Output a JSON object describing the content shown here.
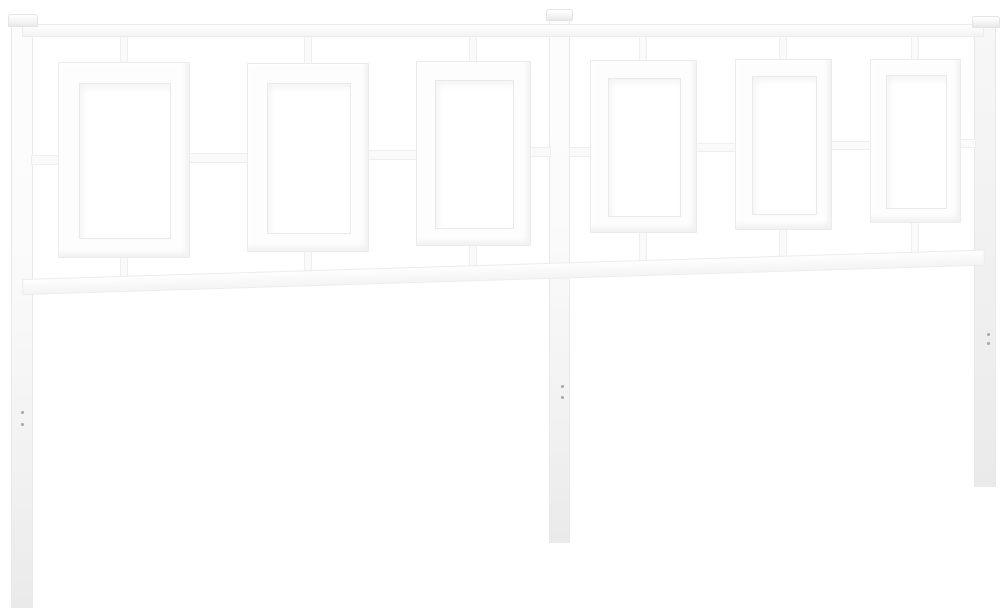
{
  "meta": {
    "description": "Product photo of a white metal bed headboard with three vertical posts, a top rail, a lower rail and six rectangular open frames linked by short square-tube connectors, photographed on a plain white background with slight perspective toward the right",
    "canvas": {
      "width": 1003,
      "height": 614
    },
    "colors": {
      "background": "#ffffff",
      "metal": "#fdfdfd",
      "metal_shade": "#efefef",
      "edge": "#e9e9e9",
      "hole_edge": "#e9e9e9",
      "dot": "#a8a8a8"
    }
  },
  "scene": {
    "pieces": [
      {
        "type": "post",
        "name": "left-post-leg",
        "x": 11,
        "y": 25,
        "w": 22,
        "h": 583
      },
      {
        "type": "post",
        "name": "center-post-leg",
        "x": 549,
        "y": 20,
        "w": 21,
        "h": 523
      },
      {
        "type": "post",
        "name": "right-post-leg",
        "x": 974,
        "y": 27,
        "w": 22,
        "h": 460,
        "shade": "leg-gray"
      },
      {
        "type": "connector-h",
        "name": "mid-link-post-to-frame-1",
        "x": 31,
        "y": 155,
        "w": 29,
        "h": 10
      },
      {
        "type": "connector-h",
        "name": "mid-link-frame-1-to-2",
        "x": 188,
        "y": 153,
        "w": 61,
        "h": 10
      },
      {
        "type": "connector-h",
        "name": "mid-link-frame-2-to-3",
        "x": 367,
        "y": 150,
        "w": 51,
        "h": 10
      },
      {
        "type": "connector-h",
        "name": "mid-link-frame-3-to-post",
        "x": 529,
        "y": 147,
        "w": 22,
        "h": 10
      },
      {
        "type": "connector-h",
        "name": "mid-link-post-to-frame-4",
        "x": 569,
        "y": 147,
        "w": 23,
        "h": 10
      },
      {
        "type": "connector-h",
        "name": "mid-link-frame-4-to-5",
        "x": 695,
        "y": 143,
        "w": 42,
        "h": 9
      },
      {
        "type": "connector-h",
        "name": "mid-link-frame-5-to-6",
        "x": 830,
        "y": 141,
        "w": 42,
        "h": 9
      },
      {
        "type": "connector-h",
        "name": "mid-link-frame-6-to-post",
        "x": 959,
        "y": 139,
        "w": 17,
        "h": 9
      },
      {
        "type": "connector-v",
        "name": "top-link-frame-1",
        "x": 120,
        "y": 35,
        "w": 8,
        "h": 30
      },
      {
        "type": "connector-v",
        "name": "top-link-frame-2",
        "x": 304,
        "y": 35,
        "w": 8,
        "h": 31
      },
      {
        "type": "connector-v",
        "name": "top-link-frame-3",
        "x": 469,
        "y": 35,
        "w": 8,
        "h": 29
      },
      {
        "type": "connector-v",
        "name": "top-link-frame-4",
        "x": 639,
        "y": 35,
        "w": 8,
        "h": 28
      },
      {
        "type": "connector-v",
        "name": "top-link-frame-5",
        "x": 779,
        "y": 35,
        "w": 8,
        "h": 27
      },
      {
        "type": "connector-v",
        "name": "top-link-frame-6",
        "x": 911,
        "y": 35,
        "w": 8,
        "h": 27
      },
      {
        "type": "connector-v",
        "name": "bottom-link-frame-1",
        "x": 120,
        "y": 256,
        "w": 8,
        "h": 23
      },
      {
        "type": "connector-v",
        "name": "bottom-link-frame-2",
        "x": 304,
        "y": 250,
        "w": 8,
        "h": 23
      },
      {
        "type": "connector-v",
        "name": "bottom-link-frame-3",
        "x": 469,
        "y": 244,
        "w": 8,
        "h": 24
      },
      {
        "type": "connector-v",
        "name": "bottom-link-frame-4",
        "x": 639,
        "y": 231,
        "w": 8,
        "h": 32
      },
      {
        "type": "connector-v",
        "name": "bottom-link-frame-5",
        "x": 779,
        "y": 228,
        "w": 8,
        "h": 31
      },
      {
        "type": "connector-v",
        "name": "bottom-link-frame-6",
        "x": 911,
        "y": 221,
        "w": 8,
        "h": 33
      },
      {
        "type": "rail",
        "name": "top-rail",
        "x": 22,
        "y": 24,
        "w": 962,
        "h": 13
      },
      {
        "type": "rail",
        "name": "bottom-rail",
        "x": 22,
        "y": 279,
        "w": 963,
        "h": 16,
        "rotate": -1.75
      },
      {
        "type": "frame",
        "name": "frame-1",
        "x": 58,
        "y": 62,
        "w": 132,
        "h": 196,
        "t": 20
      },
      {
        "type": "frame",
        "name": "frame-2",
        "x": 247,
        "y": 63,
        "w": 122,
        "h": 189,
        "t": 19
      },
      {
        "type": "frame",
        "name": "frame-3",
        "x": 416,
        "y": 61,
        "w": 115,
        "h": 185,
        "t": 18
      },
      {
        "type": "frame",
        "name": "frame-4",
        "x": 590,
        "y": 60,
        "w": 107,
        "h": 173,
        "t": 17
      },
      {
        "type": "frame",
        "name": "frame-5",
        "x": 735,
        "y": 59,
        "w": 97,
        "h": 171,
        "t": 16
      },
      {
        "type": "frame",
        "name": "frame-6",
        "x": 870,
        "y": 59,
        "w": 91,
        "h": 164,
        "t": 15
      },
      {
        "type": "cap",
        "name": "left-post-cap",
        "x": 8,
        "y": 14,
        "w": 30,
        "h": 13
      },
      {
        "type": "cap",
        "name": "center-post-cap",
        "x": 546,
        "y": 9,
        "w": 27,
        "h": 12
      },
      {
        "type": "cap",
        "name": "right-post-cap",
        "x": 972,
        "y": 16,
        "w": 28,
        "h": 12
      },
      {
        "type": "dot",
        "name": "left-leg-screw-hole-1",
        "x": 21,
        "y": 411,
        "w": 3,
        "h": 3
      },
      {
        "type": "dot",
        "name": "left-leg-screw-hole-2",
        "x": 21,
        "y": 423,
        "w": 3,
        "h": 3
      },
      {
        "type": "dot",
        "name": "center-leg-screw-hole-1",
        "x": 561,
        "y": 385,
        "w": 3,
        "h": 3
      },
      {
        "type": "dot",
        "name": "center-leg-screw-hole-2",
        "x": 561,
        "y": 396,
        "w": 3,
        "h": 3
      },
      {
        "type": "dot",
        "name": "right-leg-screw-hole-1",
        "x": 987,
        "y": 333,
        "w": 3,
        "h": 3
      },
      {
        "type": "dot",
        "name": "right-leg-screw-hole-2",
        "x": 987,
        "y": 342,
        "w": 3,
        "h": 3
      }
    ]
  }
}
